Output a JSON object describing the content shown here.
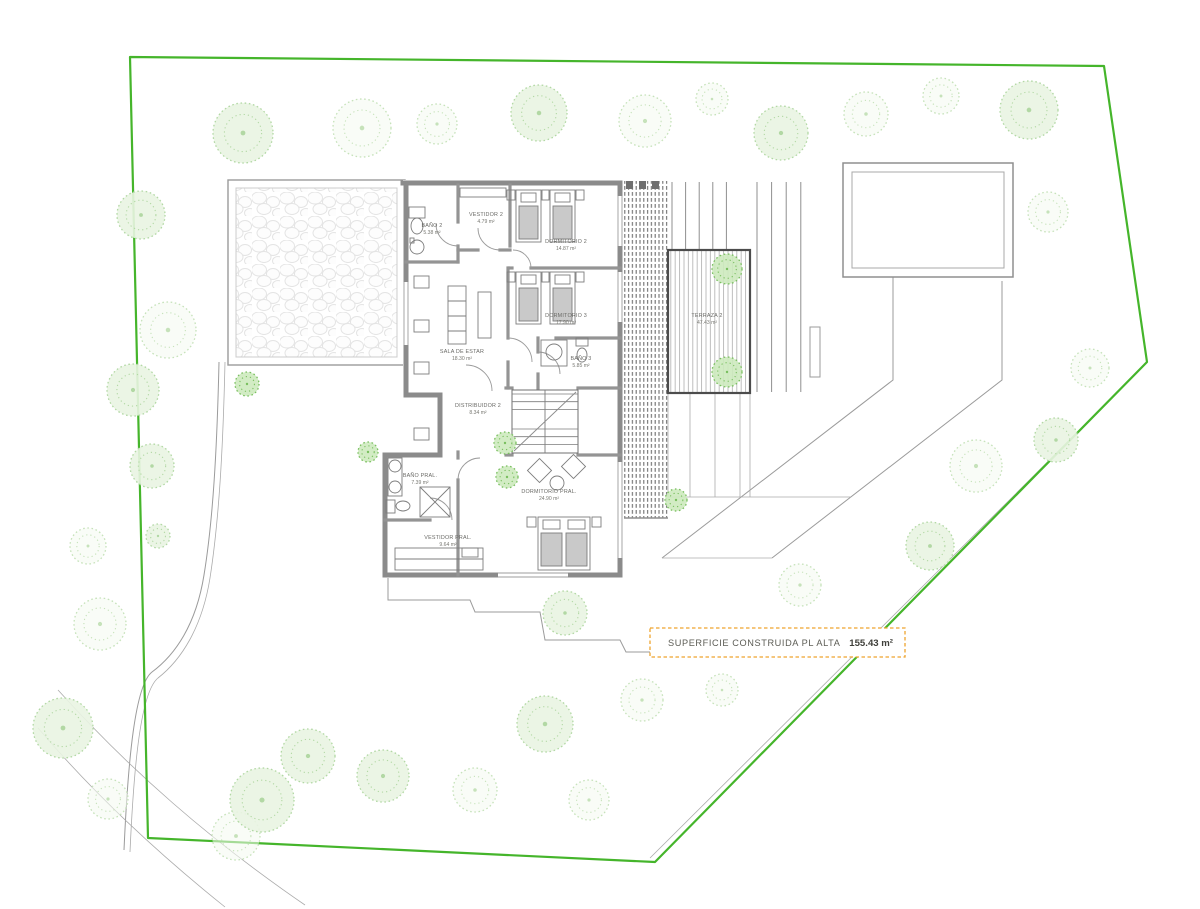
{
  "plan": {
    "summary": {
      "label": "SUPERFICIE CONSTRUIDA PL ALTA",
      "value": "155.43 m²",
      "border_color": "#EFA42F"
    },
    "rooms": [
      {
        "name": "BAÑO 2",
        "area": "5.38 m²"
      },
      {
        "name": "VESTIDOR 2",
        "area": "4.79 m²"
      },
      {
        "name": "DORMITORIO 2",
        "area": "14.87 m²"
      },
      {
        "name": "DORMITORIO 3",
        "area": "17.90 m²"
      },
      {
        "name": "SALA DE ESTAR",
        "area": "18.30 m²"
      },
      {
        "name": "BAÑO 3",
        "area": "5.85 m²"
      },
      {
        "name": "DISTRIBUIDOR 2",
        "area": "8.34 m²"
      },
      {
        "name": "BAÑO PRAL.",
        "area": "7.39 m²"
      },
      {
        "name": "DORMITORIO PRAL.",
        "area": "24.90 m²"
      },
      {
        "name": "VESTIDOR PRAL.",
        "area": "9.64 m²"
      },
      {
        "name": "TERRAZA 2",
        "area": "47.43 m²"
      }
    ]
  },
  "site": {
    "boundary_color": "#45B52B",
    "boundary_points": "130,57 1104,66 1147,362 655,862 148,838",
    "tree_styles": {
      "f": {
        "fill": "#e9f4e2",
        "stroke": "#b2d8a4"
      },
      "s": {
        "fill": "#f4faf0",
        "stroke": "#c6e2ba"
      },
      "g": {
        "fill": "#cdeabe",
        "stroke": "#79bf5f"
      }
    },
    "trees": [
      {
        "x": 243,
        "y": 133,
        "r": 30,
        "s": "f"
      },
      {
        "x": 362,
        "y": 128,
        "r": 29,
        "s": "s"
      },
      {
        "x": 437,
        "y": 124,
        "r": 20,
        "s": "s"
      },
      {
        "x": 539,
        "y": 113,
        "r": 28,
        "s": "f"
      },
      {
        "x": 645,
        "y": 121,
        "r": 26,
        "s": "s"
      },
      {
        "x": 712,
        "y": 99,
        "r": 16,
        "s": "s"
      },
      {
        "x": 781,
        "y": 133,
        "r": 27,
        "s": "f"
      },
      {
        "x": 866,
        "y": 114,
        "r": 22,
        "s": "s"
      },
      {
        "x": 941,
        "y": 96,
        "r": 18,
        "s": "s"
      },
      {
        "x": 1029,
        "y": 110,
        "r": 29,
        "s": "f"
      },
      {
        "x": 1048,
        "y": 212,
        "r": 20,
        "s": "s"
      },
      {
        "x": 141,
        "y": 215,
        "r": 24,
        "s": "f"
      },
      {
        "x": 168,
        "y": 330,
        "r": 28,
        "s": "s"
      },
      {
        "x": 133,
        "y": 390,
        "r": 26,
        "s": "f"
      },
      {
        "x": 247,
        "y": 384,
        "r": 12,
        "s": "g"
      },
      {
        "x": 152,
        "y": 466,
        "r": 22,
        "s": "f"
      },
      {
        "x": 88,
        "y": 546,
        "r": 18,
        "s": "s"
      },
      {
        "x": 158,
        "y": 536,
        "r": 12,
        "s": "f"
      },
      {
        "x": 100,
        "y": 624,
        "r": 26,
        "s": "s"
      },
      {
        "x": 63,
        "y": 728,
        "r": 30,
        "s": "f"
      },
      {
        "x": 108,
        "y": 799,
        "r": 20,
        "s": "s"
      },
      {
        "x": 236,
        "y": 836,
        "r": 24,
        "s": "s"
      },
      {
        "x": 262,
        "y": 800,
        "r": 32,
        "s": "f"
      },
      {
        "x": 308,
        "y": 756,
        "r": 27,
        "s": "f"
      },
      {
        "x": 383,
        "y": 776,
        "r": 26,
        "s": "f"
      },
      {
        "x": 475,
        "y": 790,
        "r": 22,
        "s": "s"
      },
      {
        "x": 545,
        "y": 724,
        "r": 28,
        "s": "f"
      },
      {
        "x": 589,
        "y": 800,
        "r": 20,
        "s": "s"
      },
      {
        "x": 642,
        "y": 700,
        "r": 21,
        "s": "s"
      },
      {
        "x": 722,
        "y": 690,
        "r": 16,
        "s": "s"
      },
      {
        "x": 676,
        "y": 643,
        "r": 14,
        "s": "s"
      },
      {
        "x": 800,
        "y": 585,
        "r": 21,
        "s": "s"
      },
      {
        "x": 930,
        "y": 546,
        "r": 24,
        "s": "f"
      },
      {
        "x": 976,
        "y": 466,
        "r": 26,
        "s": "s"
      },
      {
        "x": 1056,
        "y": 440,
        "r": 22,
        "s": "f"
      },
      {
        "x": 1090,
        "y": 368,
        "r": 19,
        "s": "s"
      },
      {
        "x": 565,
        "y": 613,
        "r": 22,
        "s": "f"
      },
      {
        "x": 727,
        "y": 269,
        "r": 15,
        "s": "g"
      },
      {
        "x": 727,
        "y": 372,
        "r": 15,
        "s": "g"
      },
      {
        "x": 676,
        "y": 500,
        "r": 11,
        "s": "g"
      },
      {
        "x": 505,
        "y": 443,
        "r": 11,
        "s": "g"
      },
      {
        "x": 507,
        "y": 477,
        "r": 11,
        "s": "g"
      },
      {
        "x": 368,
        "y": 452,
        "r": 10,
        "s": "g"
      }
    ]
  }
}
